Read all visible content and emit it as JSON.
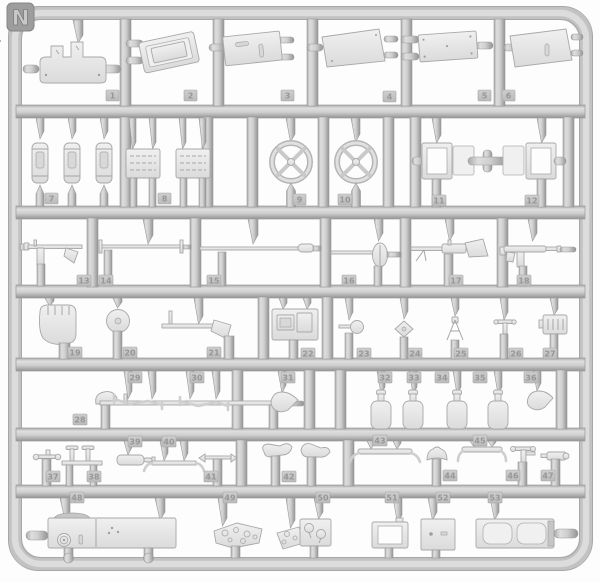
{
  "sprue": {
    "label": "N"
  },
  "part_numbers": [
    "1",
    "2",
    "3",
    "4",
    "5",
    "6",
    "7",
    "8",
    "9",
    "10",
    "11",
    "12",
    "13",
    "14",
    "15",
    "16",
    "17",
    "18",
    "19",
    "20",
    "21",
    "22",
    "23",
    "24",
    "25",
    "26",
    "27",
    "28",
    "29",
    "30",
    "31",
    "32",
    "33",
    "34",
    "35",
    "36",
    "37",
    "38",
    "39",
    "40",
    "41",
    "42",
    "43",
    "44",
    "45",
    "46",
    "47",
    "48",
    "49",
    "50",
    "51",
    "52",
    "53"
  ],
  "colors": {
    "background": "#fdfdfd",
    "runner": "#c2c2c2",
    "runner_shadow": "#939393",
    "runner_highlight": "#dedede",
    "part_fill": "#e9e9e9",
    "part_outline": "#a8a8a8",
    "tag_fill": "#c6c6c6",
    "tag_text": "#979797",
    "label_tab": "#9d9d9d",
    "label_text": "#c8c8c8"
  }
}
